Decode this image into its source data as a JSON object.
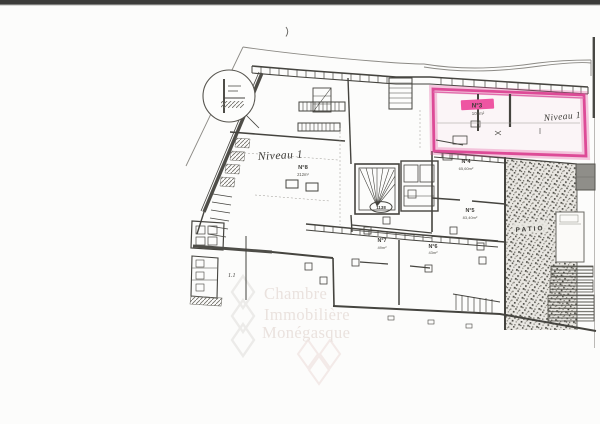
{
  "page": {
    "type": "scanned-floor-plan",
    "background_color": "#fcfcfb",
    "scan_bar_color": "#3c3c3a",
    "ink_color": "#45443f",
    "highlight_color": "#e0519c"
  },
  "plan": {
    "units": [
      {
        "id": "N°3",
        "area": "109m²",
        "highlighted": true
      },
      {
        "id": "N°4",
        "area": "65,60m²",
        "highlighted": false
      },
      {
        "id": "N°5",
        "area": "83,40m²",
        "highlighted": false
      },
      {
        "id": "N°6",
        "area": "43m²",
        "highlighted": false
      },
      {
        "id": "N°7",
        "area": "49m²",
        "highlighted": false
      },
      {
        "id": "N°8",
        "area": "212m²",
        "highlighted": false
      }
    ],
    "annotations": {
      "niveau_left": "Niveau 1",
      "niveau_right": "Niveau 1",
      "patio_label": "PATIO",
      "stair_oval_ref": "1138",
      "detail_ref": "1.1"
    }
  },
  "watermark": {
    "lines": [
      "Chambre",
      "Immobilière",
      "Monégasque"
    ],
    "color": "#eae2de"
  }
}
